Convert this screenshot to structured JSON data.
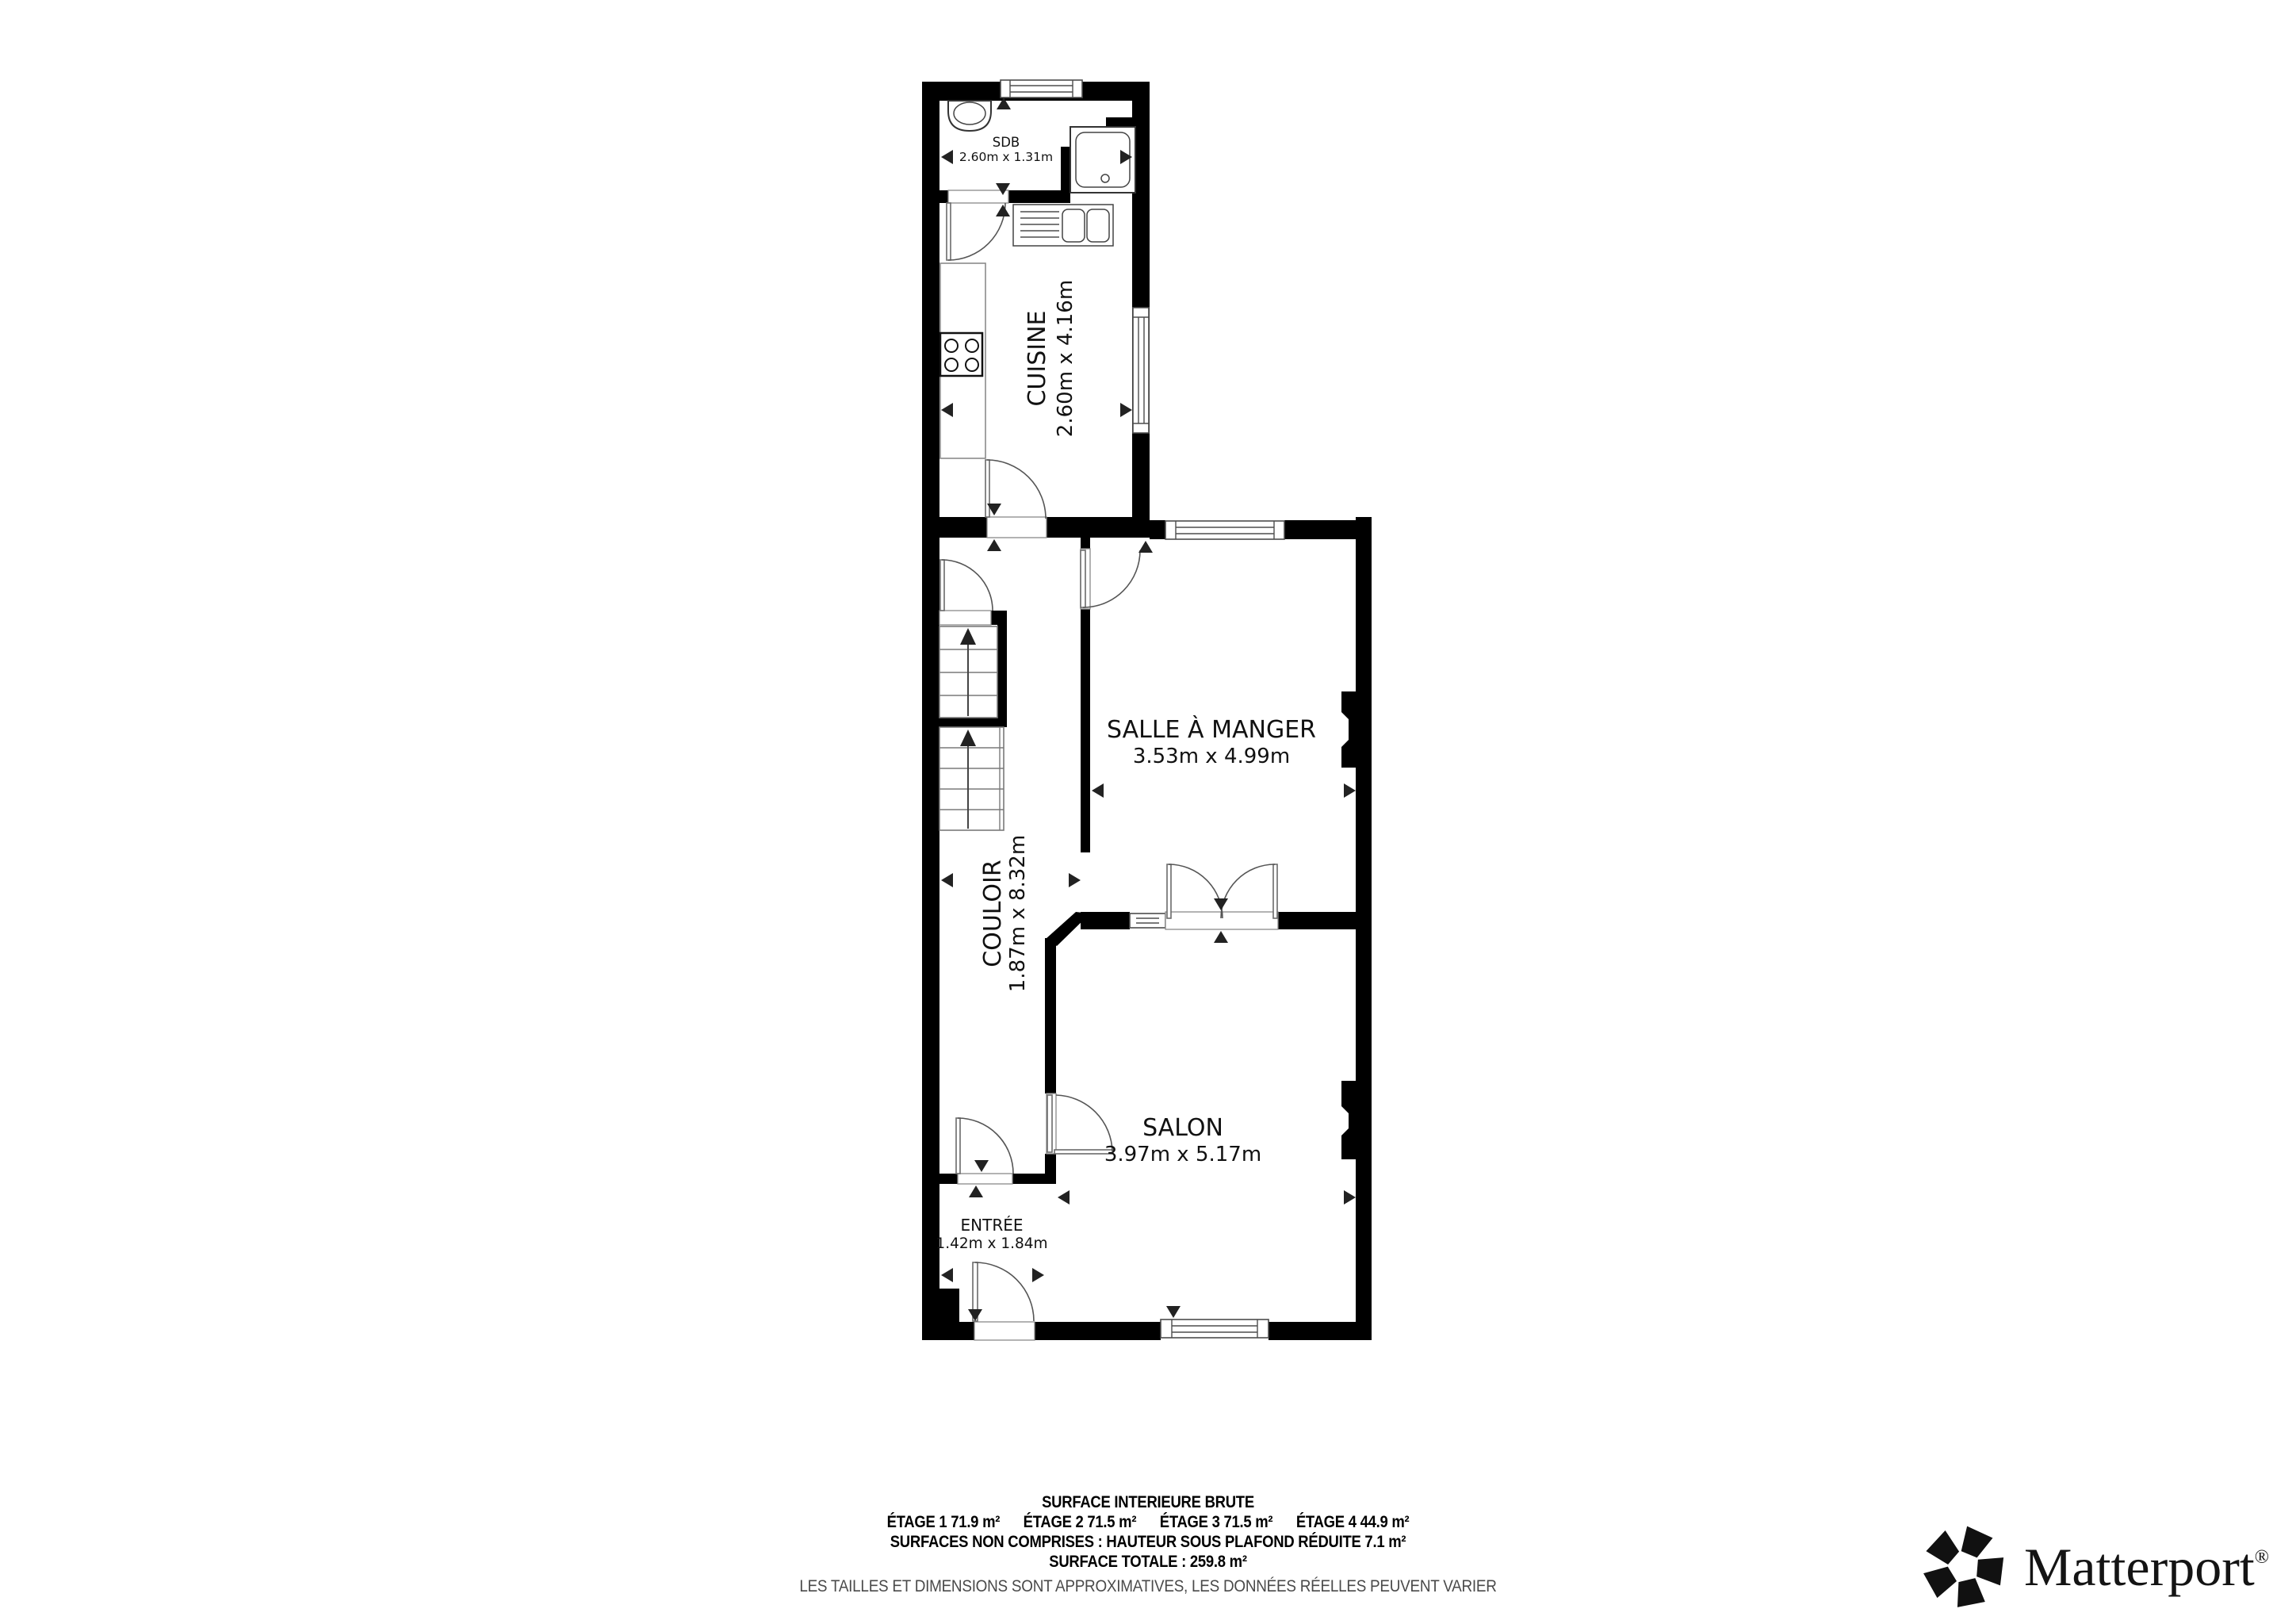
{
  "plan_title": "floor-plan",
  "rooms": {
    "sdb": {
      "name": "SDB",
      "dims": "2.60m x 1.31m"
    },
    "cuisine": {
      "name": "CUISINE",
      "dims": "2.60m x 4.16m"
    },
    "salle_a_manger": {
      "name": "SALLE À MANGER",
      "dims": "3.53m x 4.99m"
    },
    "couloir": {
      "name": "COULOIR",
      "dims": "1.87m x 8.32m"
    },
    "salon": {
      "name": "SALON",
      "dims": "3.97m x 5.17m"
    },
    "entree": {
      "name": "ENTRÉE",
      "dims": "1.42m x 1.84m"
    }
  },
  "footer": {
    "title": "SURFACE INTERIEURE BRUTE",
    "etages": [
      "ÉTAGE 1 71.9 m²",
      "ÉTAGE 2 71.5 m²",
      "ÉTAGE 3 71.5 m²",
      "ÉTAGE 4 44.9 m²"
    ],
    "exclusions": "SURFACES NON COMPRISES :  HAUTEUR SOUS PLAFOND RÉDUITE 7.1 m²",
    "total": "SURFACE TOTALE :  259.8 m²",
    "disclaimer": "LES TAILLES ET DIMENSIONS SONT APPROXIMATIVES, LES DONNÉES RÉELLES PEUVENT VARIER"
  },
  "brand": {
    "name": "Matterport",
    "registered_mark": "®"
  },
  "colors": {
    "walls": "#000000",
    "door_lines": "#555555",
    "disclaimer_text": "#4a4a4a"
  }
}
